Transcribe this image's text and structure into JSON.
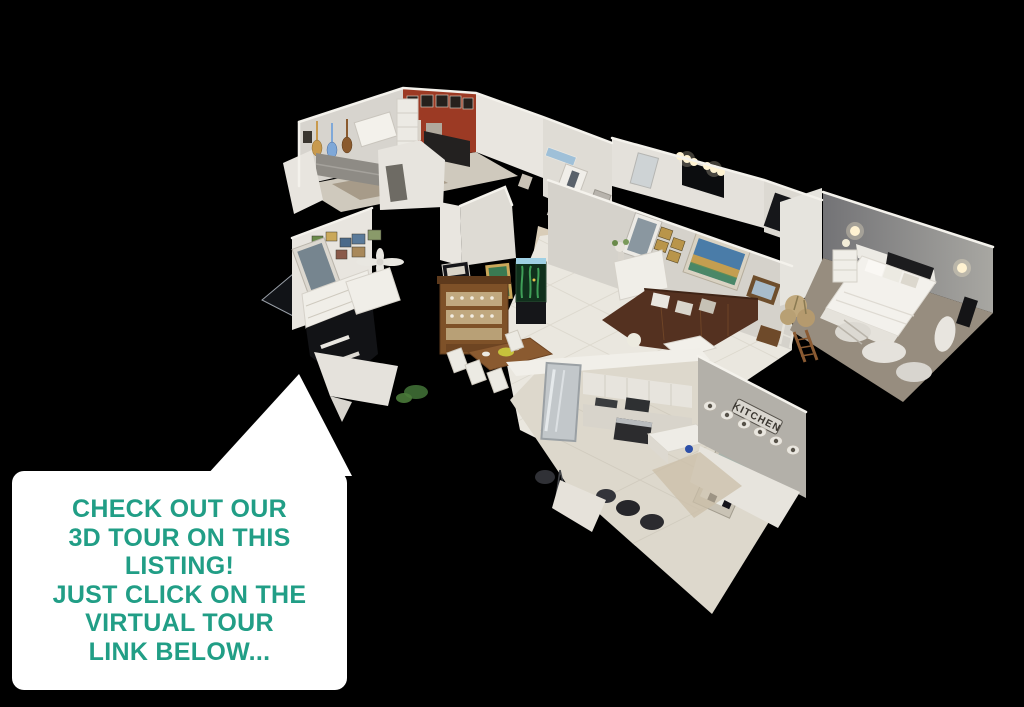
{
  "scene": {
    "background_color": "#000000"
  },
  "speech_bubble": {
    "lines": [
      "CHECK OUT OUR",
      "3D TOUR ON THIS",
      "LISTING!",
      "JUST CLICK ON THE",
      "VIRTUAL TOUR",
      "LINK BELOW..."
    ],
    "text_color": "#219e86",
    "bubble_color": "#ffffff"
  },
  "house": {
    "kitchen_sign_label": "KITCHEN",
    "colors": {
      "brick_accent_wall": "#9c3a24",
      "leather_sofa": "#543120",
      "wood_hutch": "#7e5128",
      "bedroom_wall_gray": "#8b8b89",
      "wall_white": "#e9e6e0",
      "tile_floor": "#eae7df",
      "carpet_tan": "#978d7f",
      "aquarium_plant_green": "#3f9e58",
      "lamp_glow": "#fff3d2"
    }
  }
}
